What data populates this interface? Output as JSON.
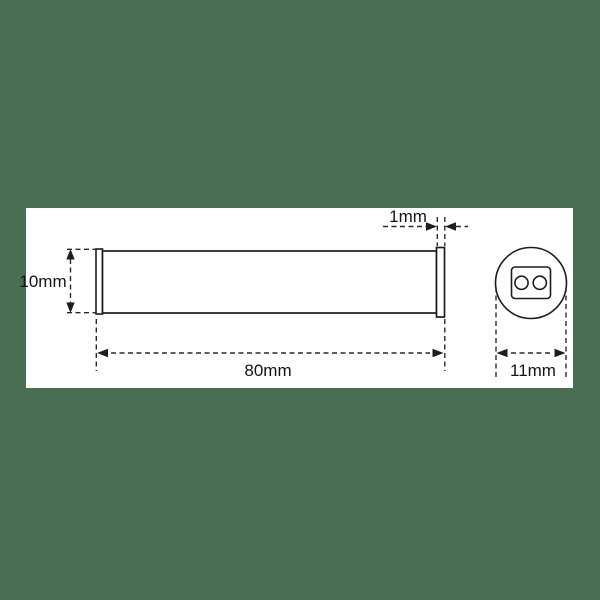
{
  "page": {
    "background_color": "#496e54",
    "canvas_color": "#ffffff",
    "line_color": "#1d1d1b"
  },
  "drawing": {
    "type": "technical-dimension-drawing",
    "views": [
      "side-view-cylinder",
      "end-view-circle-with-two-pins"
    ],
    "side_view": {
      "height_label": "10mm",
      "flange_label": "1mm",
      "length_label": "80mm"
    },
    "end_view": {
      "diameter_label": "11mm"
    },
    "dimensions_mm": {
      "body_height": 10,
      "flange_thickness": 1,
      "body_length": 80,
      "end_diameter": 11
    }
  }
}
